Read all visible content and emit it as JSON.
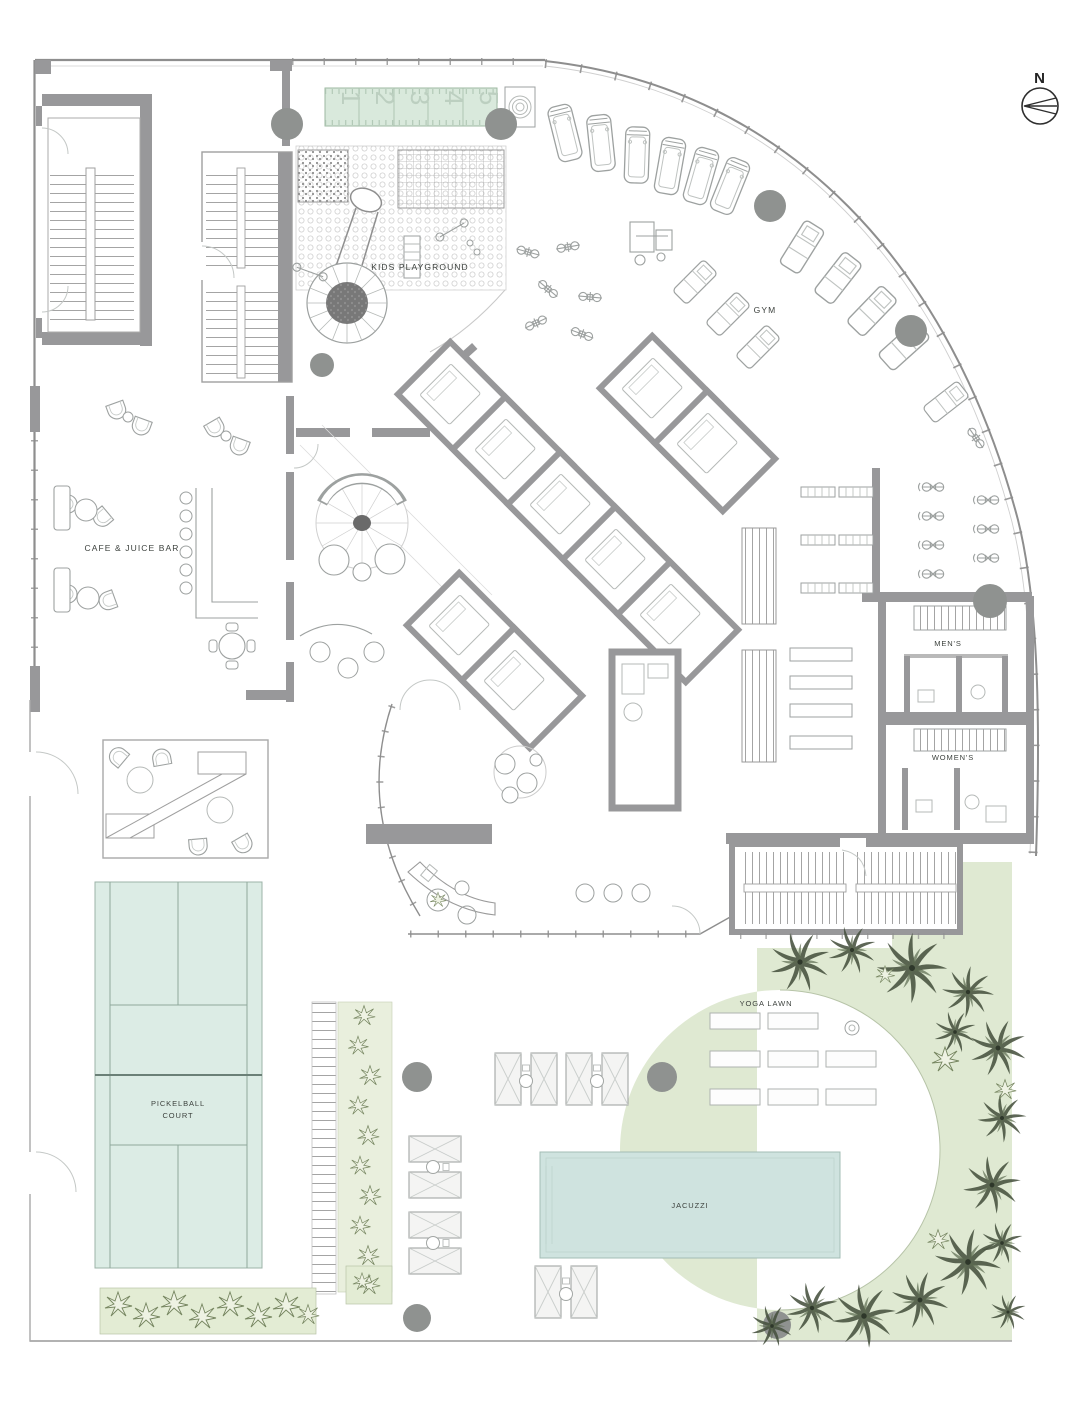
{
  "labels": {
    "kids_playground": "KIDS PLAYGROUND",
    "gym": "GYM",
    "cafe_juice_bar": "CAFE & JUICE BAR",
    "mens": "MEN'S",
    "womens": "WOMEN'S",
    "pickelball_line1": "PICKELBALL",
    "pickelball_line2": "COURT",
    "yoga_lawn": "YOGA LAWN",
    "jacuzzi": "JACUZZI"
  },
  "north_indicator": {
    "label": "N"
  },
  "track_lanes": [
    "1",
    "2",
    "3",
    "4",
    "5"
  ],
  "colors": {
    "wall_gray": "#98989a",
    "column_gray": "#8f9290",
    "line_light": "#b5b9b7",
    "court_green": "#dcece5",
    "pool_teal": "#cfe3df",
    "landscape_green": "#dfe9d2",
    "track_green": "#d9e9dc",
    "label_ink": "#3c413d",
    "palm_ink": "#47523f"
  }
}
